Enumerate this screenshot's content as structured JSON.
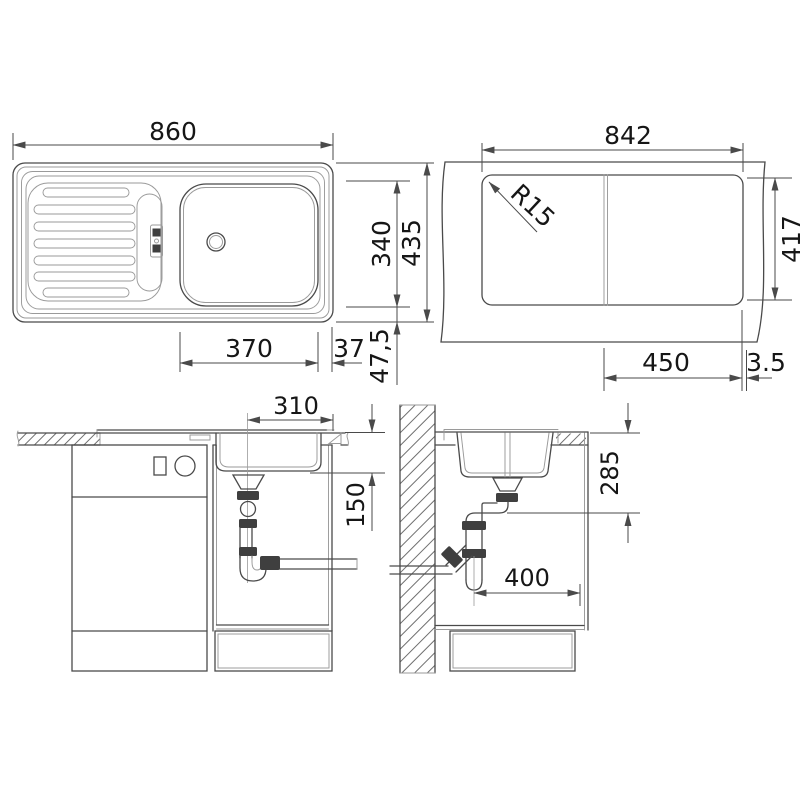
{
  "dims": {
    "plan": {
      "width": "860",
      "bowl_width": "370",
      "right_edge": "37",
      "bottom_edge": "47,5",
      "bowl_height": "340",
      "height": "435"
    },
    "cutout": {
      "width": "842",
      "corner_radius": "R15",
      "height": "417",
      "half_width": "450",
      "edge_gap": "3.5"
    },
    "front": {
      "drain_offset": "310",
      "drain_depth": "150"
    },
    "side": {
      "outlet_height": "285",
      "depth": "400"
    }
  },
  "colors": {
    "line": "#4a4a4a",
    "light": "#9a9a9a",
    "text": "#161616",
    "dark": "#3f3f3f",
    "background": "#ffffff"
  }
}
